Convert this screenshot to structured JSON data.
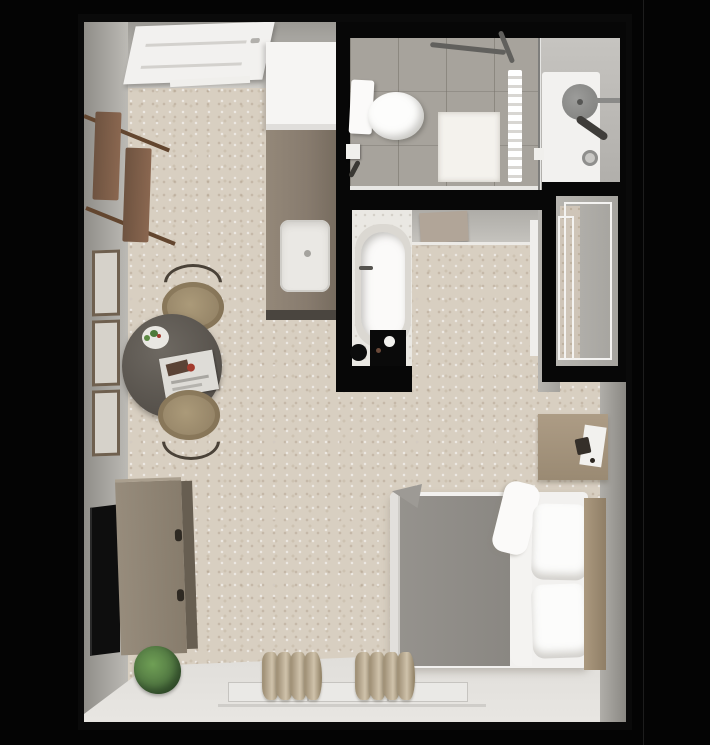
{
  "scene": {
    "title": "studio-apartment-floor-plan-3d-top-view",
    "background_color": "#040404",
    "palette": {
      "plan_wall": "#070707",
      "carpet": "#d8cfc1",
      "wall_face_gray": "#b3b1ac",
      "bathroom_tile": "#a7a39c",
      "shower_floor": "#f2f1ef",
      "counter_taupe": "#887c6f",
      "cabinet_white": "#f6f5f3",
      "wood_light": "#a2927d",
      "wood_dark": "#7b5c45",
      "duvet_gray": "#8e8b86",
      "linen_white": "#f4f3f1",
      "plant_green": "#5c8a48",
      "curtain_tan": "#b9aa92",
      "black_accent": "#0a0a0a"
    },
    "rooms": [
      {
        "name": "entry",
        "items": [
          "entry-door",
          "door-threshold",
          "coat-rack"
        ]
      },
      {
        "name": "kitchenette",
        "items": [
          "upper-cabinet",
          "counter",
          "sink"
        ]
      },
      {
        "name": "bathroom",
        "items": [
          "toilet",
          "toilet-paper-holder",
          "grab-bar",
          "bath-mat",
          "towel-rack",
          "glass-partition",
          "shower-head",
          "hand-shower",
          "shower-drain",
          "shower-control"
        ]
      },
      {
        "name": "bathtub-alcove",
        "items": [
          "bathtub",
          "tub-faucet",
          "black-mat",
          "hamper"
        ]
      },
      {
        "name": "dressing-alcove",
        "items": [
          "open-door-panel",
          "door-frame"
        ]
      },
      {
        "name": "closet",
        "items": [
          "wire-shelving",
          "closet-carpet-strip"
        ]
      },
      {
        "name": "living-bedroom",
        "items": [
          "picture-frame-1",
          "picture-frame-2",
          "picture-frame-3",
          "dining-table",
          "dining-chair-top",
          "dining-chair-bottom",
          "plate-with-greens",
          "magazine",
          "tv",
          "media-dresser",
          "floor-plant",
          "bed-mattress",
          "gray-duvet",
          "white-sheet",
          "pillow-1",
          "pillow-2",
          "headboard",
          "nightstand",
          "window",
          "curtains"
        ]
      }
    ]
  }
}
